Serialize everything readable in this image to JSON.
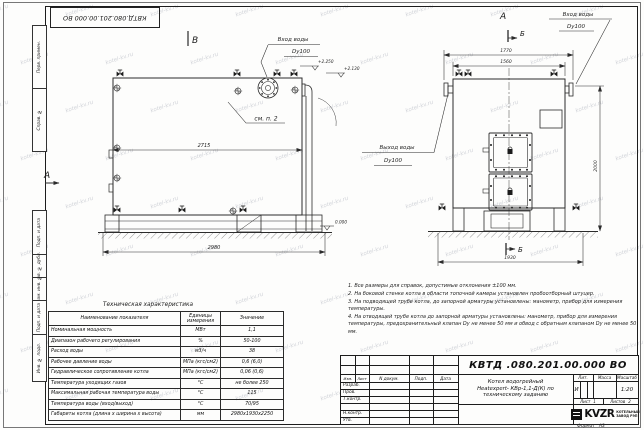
{
  "watermark": "kotel-kv.ru",
  "stamp": {
    "doc_number": "КВТД.080.201.00.000 ВО"
  },
  "margin": {
    "top1": "Перв. примен.",
    "top2": "Справ. №",
    "b1": "Подп. и дата",
    "b2": "Инв. № дубл.",
    "b3": "Взам. инв. №",
    "b4": "Подп. и дата",
    "b5": "Инв. № подл."
  },
  "side_view": {
    "view_letter": "В",
    "marker_letter": "А",
    "inlet_line1": "Вход воды",
    "inlet_line2": "Dy100",
    "outlet_line1": "Выход воды",
    "outlet_line2": "Dy100",
    "see_note": "см. п. 2",
    "dim_inner": "2715",
    "dim_total": "2980",
    "elev_top": "+2.250",
    "elev_outlet": "+2.130",
    "elev_zero": "0.000"
  },
  "front_view": {
    "view_letter": "А",
    "section_letter": "Б",
    "inlet_line1": "Вход воды",
    "inlet_line2": "Dy100",
    "dim_outer": "1770",
    "dim_inner": "1560",
    "dim_height": "2000",
    "dim_base": "1930"
  },
  "tech_table": {
    "title": "Техническая характеристика",
    "col1": "Наименование показателя",
    "col2": "Единицы измерения",
    "col3": "Значение",
    "rows": [
      [
        "Номинальная мощность",
        "МВт",
        "1,1"
      ],
      [
        "Диапазон рабочего регулирования",
        "%",
        "50-100"
      ],
      [
        "Расход воды",
        "м3/ч",
        "38"
      ],
      [
        "Рабочее давление воды",
        "МПа (кгс/см2)",
        "0,6 (6,0)"
      ],
      [
        "Гидравлическое сопротивление котла",
        "МПа (кгс/см2)",
        "0,06 (0,6)"
      ],
      [
        "Температура уходящих газов",
        "°С",
        "не более 250"
      ],
      [
        "Максимальная рабочая температура воды",
        "°С",
        "115"
      ],
      [
        "Температура воды (вход/выход)",
        "°С",
        "70/95"
      ],
      [
        "Габариты котла (длина х ширина х высота)",
        "мм",
        "2980х1930х2250"
      ]
    ]
  },
  "notes": [
    "1. Все размеры для справок, допустимые отклонения ±100 мм.",
    "2. На боковой стенке котла в области топочной камеры установлен пробоотборный штуцер.",
    "3. На подводящей трубе котла, до запорной арматуры установлены: манометр, прибор для измерения температуры.",
    "4. На отводящей трубе котла до запорной арматуры установлены: манометр, прибор для измерения температуры, предохранительный клапан Dу не менее 50 мм и обвод с обратным клапаном Dу не менее 50 мм."
  ],
  "title_block": {
    "doc_number": "КВТД .080.201.00.000  ВО",
    "product_line1": "Котел водогрейный",
    "product_line2": "Heatexpert- КВр-1,1-Д(К) по",
    "product_line3": "техническому заданию",
    "hdr_izm": "Изм.",
    "hdr_list": "Лист",
    "hdr_ndoc": "N докум.",
    "hdr_podp": "Подп.",
    "hdr_data": "Дата",
    "sig_rows": [
      "Разраб.",
      "Пров.",
      "Т.контр.",
      "",
      "Н.контр.",
      "Утв."
    ],
    "lit_label": "Лит.",
    "lit_value": "И",
    "mass_label": "Масса",
    "scale_label": "Масштаб",
    "scale_value": "1:20",
    "sheet_label": "Лист",
    "sheet_value": "1",
    "sheets_label": "Листов",
    "sheets_value": "2",
    "logo_text": "KVZR",
    "company_line1": "КОТЕЛЬНЫЙ",
    "company_line2": "ЗАВОД РЭП",
    "format_label": "Формат",
    "format_value": "А3"
  }
}
